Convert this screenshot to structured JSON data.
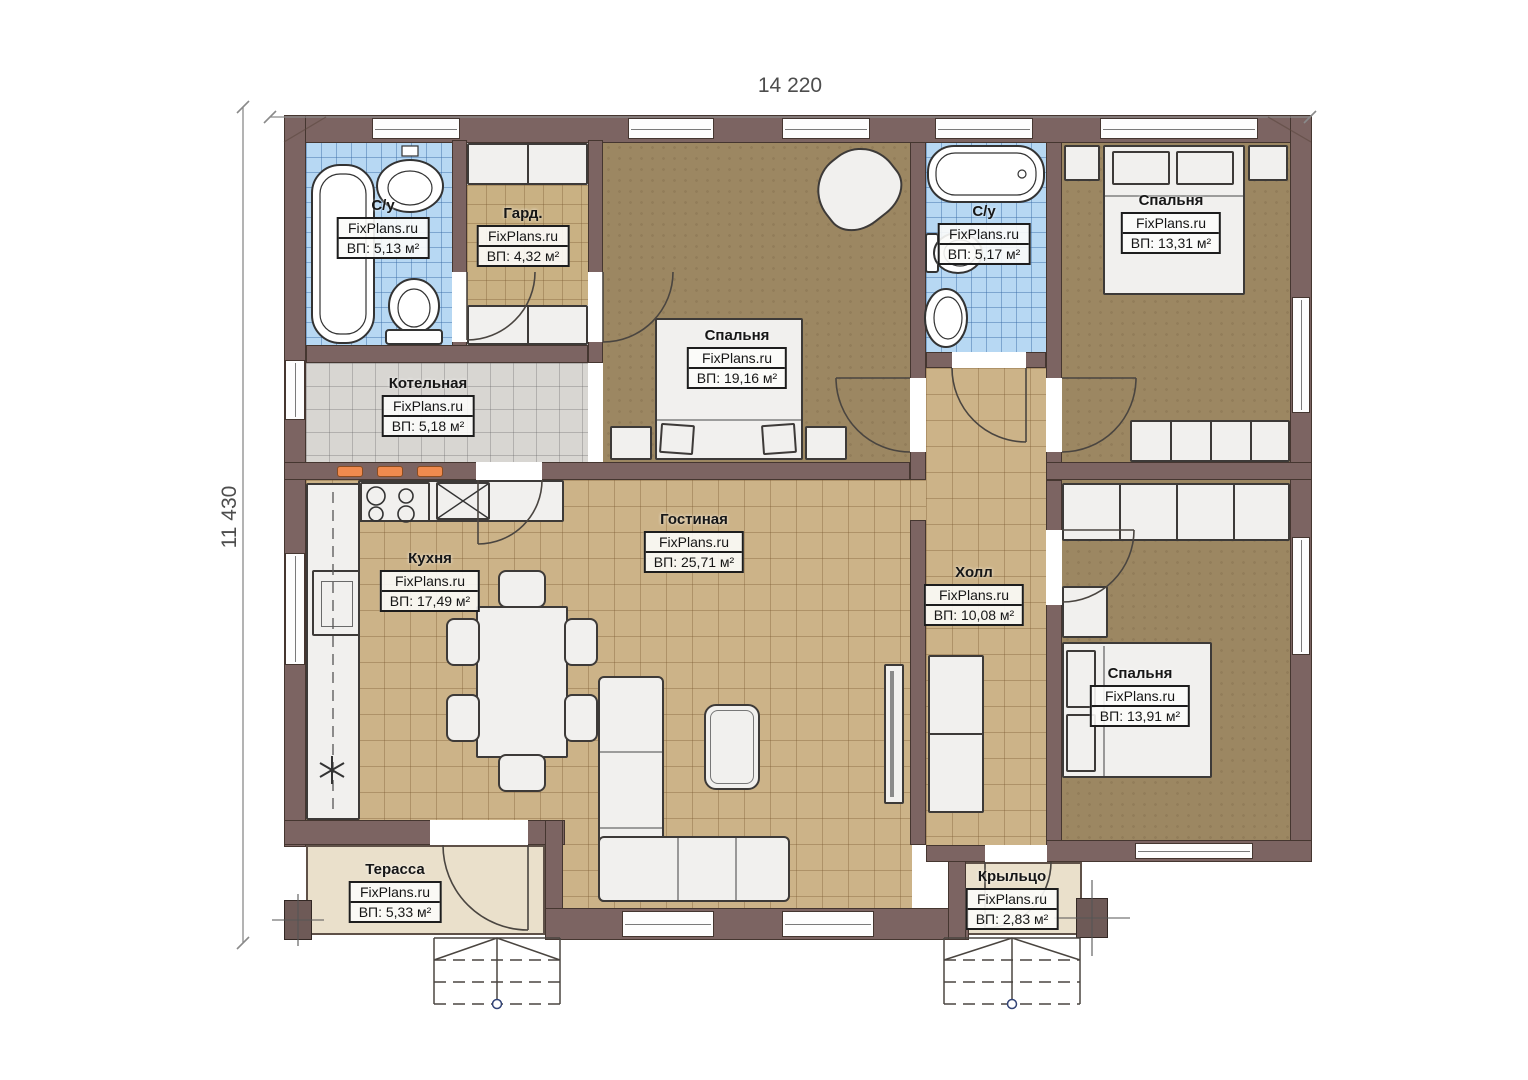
{
  "dimensions": {
    "top": "14 220",
    "left": "11 430"
  },
  "rooms": [
    {
      "id": "bathroom-1",
      "name": "С/у",
      "brand": "FixPlans.ru",
      "area": "ВП: 5,13 м²"
    },
    {
      "id": "wardrobe",
      "name": "Гард.",
      "brand": "FixPlans.ru",
      "area": "ВП: 4,32 м²"
    },
    {
      "id": "bedroom-1",
      "name": "Спальня",
      "brand": "FixPlans.ru",
      "area": "ВП: 19,16 м²"
    },
    {
      "id": "bathroom-2",
      "name": "С/у",
      "brand": "FixPlans.ru",
      "area": "ВП: 5,17 м²"
    },
    {
      "id": "bedroom-2",
      "name": "Спальня",
      "brand": "FixPlans.ru",
      "area": "ВП: 13,31 м²"
    },
    {
      "id": "boiler",
      "name": "Котельная",
      "brand": "FixPlans.ru",
      "area": "ВП: 5,18 м²"
    },
    {
      "id": "kitchen",
      "name": "Кухня",
      "brand": "FixPlans.ru",
      "area": "ВП: 17,49 м²"
    },
    {
      "id": "living",
      "name": "Гостиная",
      "brand": "FixPlans.ru",
      "area": "ВП: 25,71 м²"
    },
    {
      "id": "hall",
      "name": "Холл",
      "brand": "FixPlans.ru",
      "area": "ВП: 10,08 м²"
    },
    {
      "id": "bedroom-3",
      "name": "Спальня",
      "brand": "FixPlans.ru",
      "area": "ВП: 13,91 м²"
    },
    {
      "id": "terrace",
      "name": "Терасса",
      "brand": "FixPlans.ru",
      "area": "ВП: 5,33 м²"
    },
    {
      "id": "porch",
      "name": "Крыльцо",
      "brand": "FixPlans.ru",
      "area": "ВП: 2,83 м²"
    }
  ],
  "colors": {
    "wall": "#7c6462",
    "tile_tan": "#ccb388",
    "tile_blue": "#b7d8f3",
    "tile_gray": "#d8d6d2",
    "floor_brown": "#9c8762",
    "terrace": "#eae0cb",
    "radiator": "#ef8a4e"
  }
}
